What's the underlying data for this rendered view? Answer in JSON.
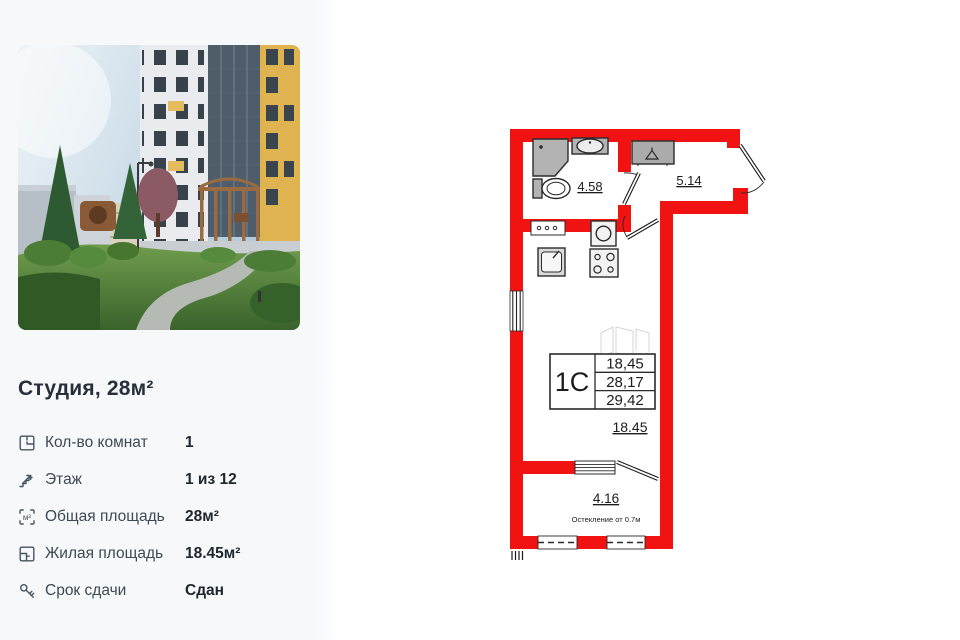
{
  "sidebar": {
    "title": "Студия, 28м²",
    "specs": [
      {
        "icon": "rooms-icon",
        "label": "Кол-во комнат",
        "value": "1"
      },
      {
        "icon": "stairs-icon",
        "label": "Этаж",
        "value": "1 из 12"
      },
      {
        "icon": "total-area-icon",
        "label": "Общая площадь",
        "value": "28м²"
      },
      {
        "icon": "living-area-icon",
        "label": "Жилая площадь",
        "value": "18.45м²"
      },
      {
        "icon": "key-icon",
        "label": "Срок сдачи",
        "value": "Сдан"
      }
    ],
    "area_icon_glyph": "м²"
  },
  "floorplan": {
    "unit_label": "1C",
    "stamp_values": [
      "18,45",
      "28,17",
      "29,42"
    ],
    "rooms": {
      "bathroom": "4.58",
      "hallway": "5.14",
      "main_room": "18.45",
      "balcony": "4.16"
    },
    "glazing_note": "Остекление от 0.7м",
    "wall_color": "#f11212",
    "fixture_gray": "#b3b3b3",
    "line_color": "#2b2b2b"
  }
}
